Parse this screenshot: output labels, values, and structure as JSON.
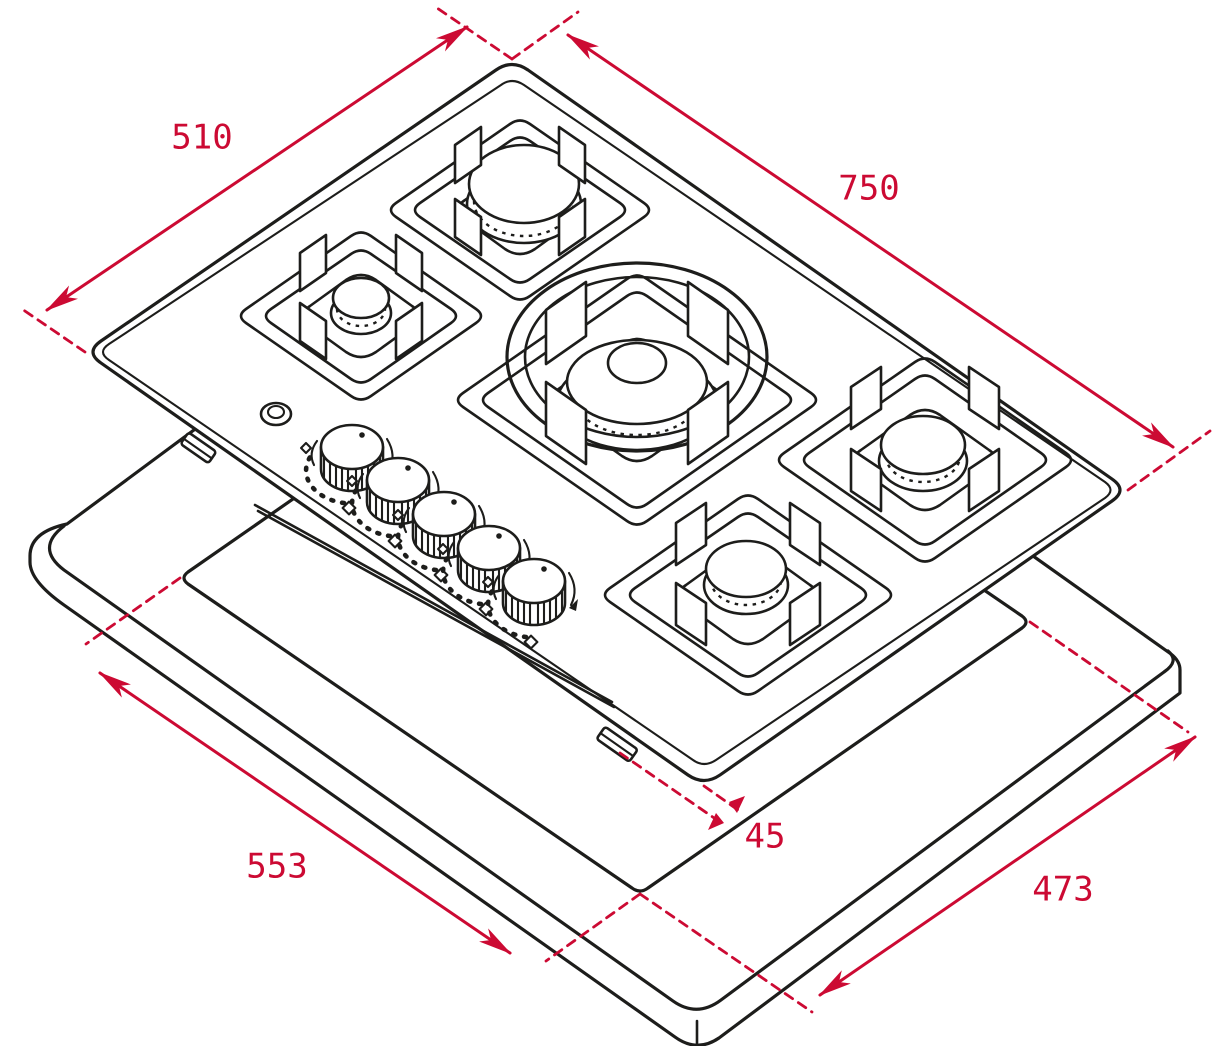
{
  "page": {
    "title": "Gas hob installation drawing",
    "background": "#ffffff"
  },
  "colors": {
    "accent_red": "#cc0a33",
    "line_black": "#1d1d1b"
  },
  "diagram": {
    "type": "isometric technical drawing",
    "product": "5-burner gas hob above worktop with installation cutout",
    "parts": {
      "burners": 5,
      "control_knobs": 5,
      "wok_ring": true,
      "ignition_button": true,
      "mounting_clips": 2
    },
    "dimensions": {
      "hob_depth": {
        "value": 510,
        "label": "510"
      },
      "hob_width": {
        "value": 750,
        "label": "750"
      },
      "cutout_length": {
        "value": 553,
        "label": "553"
      },
      "cutout_width": {
        "value": 473,
        "label": "473"
      },
      "installation_depth": {
        "value": 45,
        "label": "45"
      }
    }
  }
}
